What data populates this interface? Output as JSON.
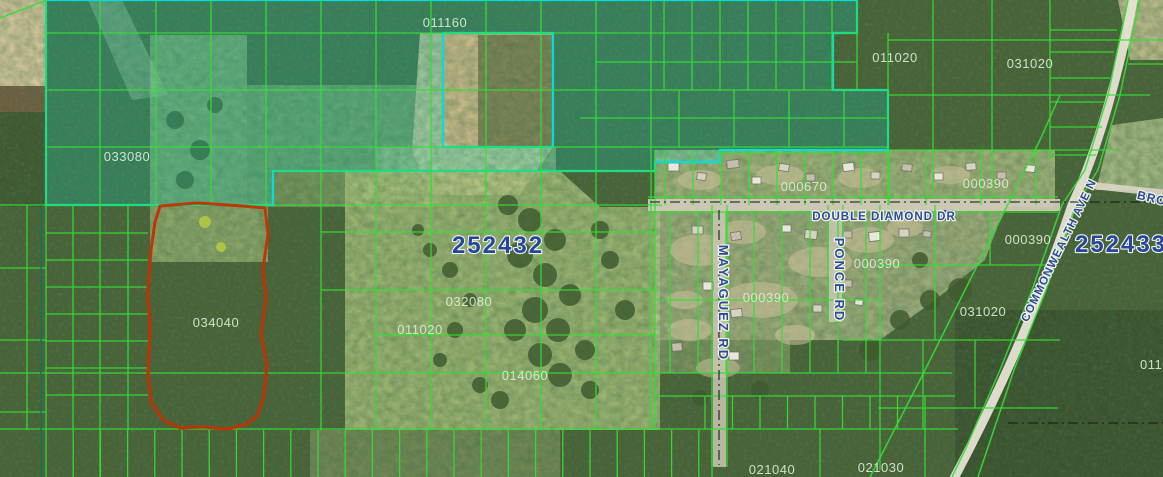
{
  "map": {
    "title": "parcel-map-aerial-view",
    "colors": {
      "grid_line": "#35dd35",
      "selection_line": "#00e0da",
      "selection_fill": "rgba(0,228,218,0.20)",
      "highlight_outline": "#c43000",
      "section_text": "#24479e",
      "road_text": "#2b4a9b",
      "parcel_text": "#d8ecd2",
      "section_dash_line": "#1b1b1b",
      "teal_boundary": "#1c6e5e"
    },
    "section_labels": [
      {
        "text": "252432",
        "x": 498,
        "y": 253,
        "fs": 24,
        "rot": 0
      },
      {
        "text": "252433",
        "x": 1121,
        "y": 252,
        "fs": 24,
        "rot": 0
      }
    ],
    "parcel_labels": [
      {
        "text": "011160",
        "x": 445,
        "y": 27
      },
      {
        "text": "011020",
        "x": 895,
        "y": 62
      },
      {
        "text": "031020",
        "x": 1030,
        "y": 68
      },
      {
        "text": "033080",
        "x": 127,
        "y": 161
      },
      {
        "text": "000670",
        "x": 804,
        "y": 191
      },
      {
        "text": "000390",
        "x": 986,
        "y": 188
      },
      {
        "text": "000390",
        "x": 1028,
        "y": 244
      },
      {
        "text": "000390",
        "x": 877,
        "y": 268
      },
      {
        "text": "000390",
        "x": 766,
        "y": 302
      },
      {
        "text": "031020",
        "x": 983,
        "y": 316
      },
      {
        "text": "032080",
        "x": 469,
        "y": 306
      },
      {
        "text": "011020",
        "x": 420,
        "y": 334
      },
      {
        "text": "034040",
        "x": 216,
        "y": 327
      },
      {
        "text": "014060",
        "x": 525,
        "y": 380
      },
      {
        "text": "021040",
        "x": 772,
        "y": 474
      },
      {
        "text": "021030",
        "x": 881,
        "y": 472
      },
      {
        "text": "0110",
        "x": 1155,
        "y": 369
      }
    ],
    "road_labels": [
      {
        "text": "DOUBLE DIAMOND DR",
        "x": 884,
        "y": 220,
        "fs": 11.5,
        "ls": 1,
        "rot": 0
      },
      {
        "text": "MAYAGUEZ RD",
        "x": 719,
        "y": 303,
        "fs": 13,
        "ls": 2,
        "rot": 90
      },
      {
        "text": "PONCE RD",
        "x": 835,
        "y": 280,
        "fs": 13,
        "ls": 2,
        "rot": 90
      },
      {
        "text": "COMMONWEALTH AVE N",
        "x": 1062,
        "y": 252,
        "fs": 11.5,
        "ls": 1,
        "rot": -64
      },
      {
        "text": "BRO",
        "x": 1151,
        "y": 202,
        "fs": 12,
        "ls": 1,
        "rot": 13
      }
    ]
  }
}
